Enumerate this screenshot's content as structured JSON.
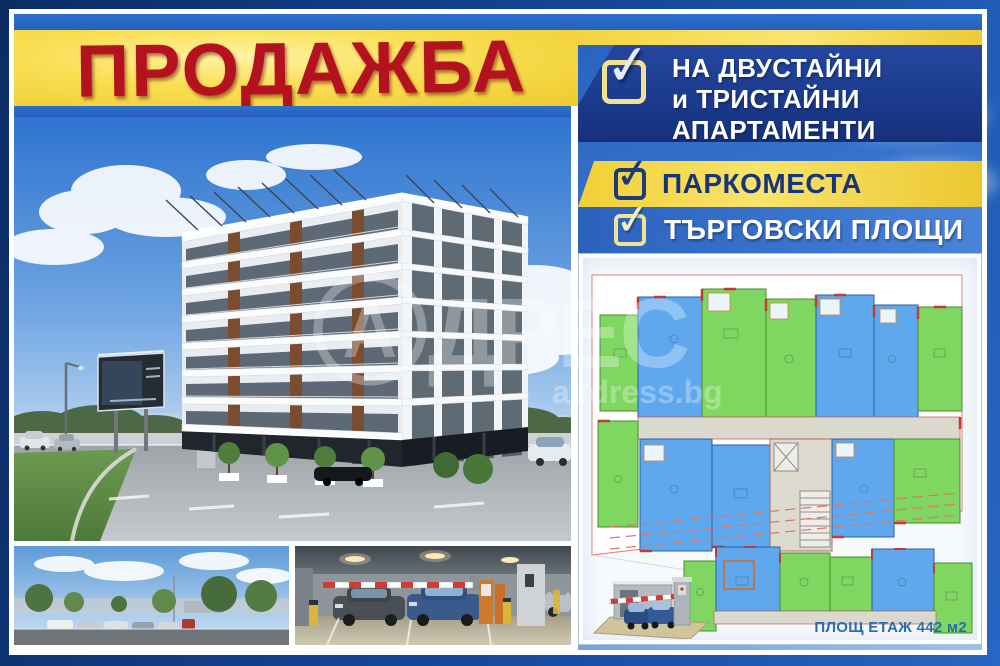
{
  "poster": {
    "title": "ПРОДАЖБА",
    "features": [
      {
        "lines": [
          "НА ДВУСТАЙНИ",
          "и ТРИСТАЙНИ",
          "АПАРТАМЕНТИ"
        ]
      },
      {
        "lines": [
          "ПАРКОМЕСТА"
        ]
      },
      {
        "lines": [
          "ТЪРГОВСКИ ПЛОЩИ"
        ]
      }
    ],
    "area_label": "ПЛОЩ ЕТАЖ 442 м2",
    "watermark": {
      "circle_letter": "А",
      "wordmark": "ДРЕС",
      "url": "address.bg"
    }
  },
  "icons": {
    "check": "✓"
  },
  "colors": {
    "frame_navy": "#12407f",
    "banner_yellow": "#f6d845",
    "title_red": "#b5121f",
    "banner_navy": "#1c3a8c",
    "royal_blue": "#2f6ac6",
    "plan_green": "#7fd761",
    "plan_blue": "#60a8ee",
    "wall_red": "#c23b2e",
    "area_label_blue": "#2b6cb0"
  }
}
